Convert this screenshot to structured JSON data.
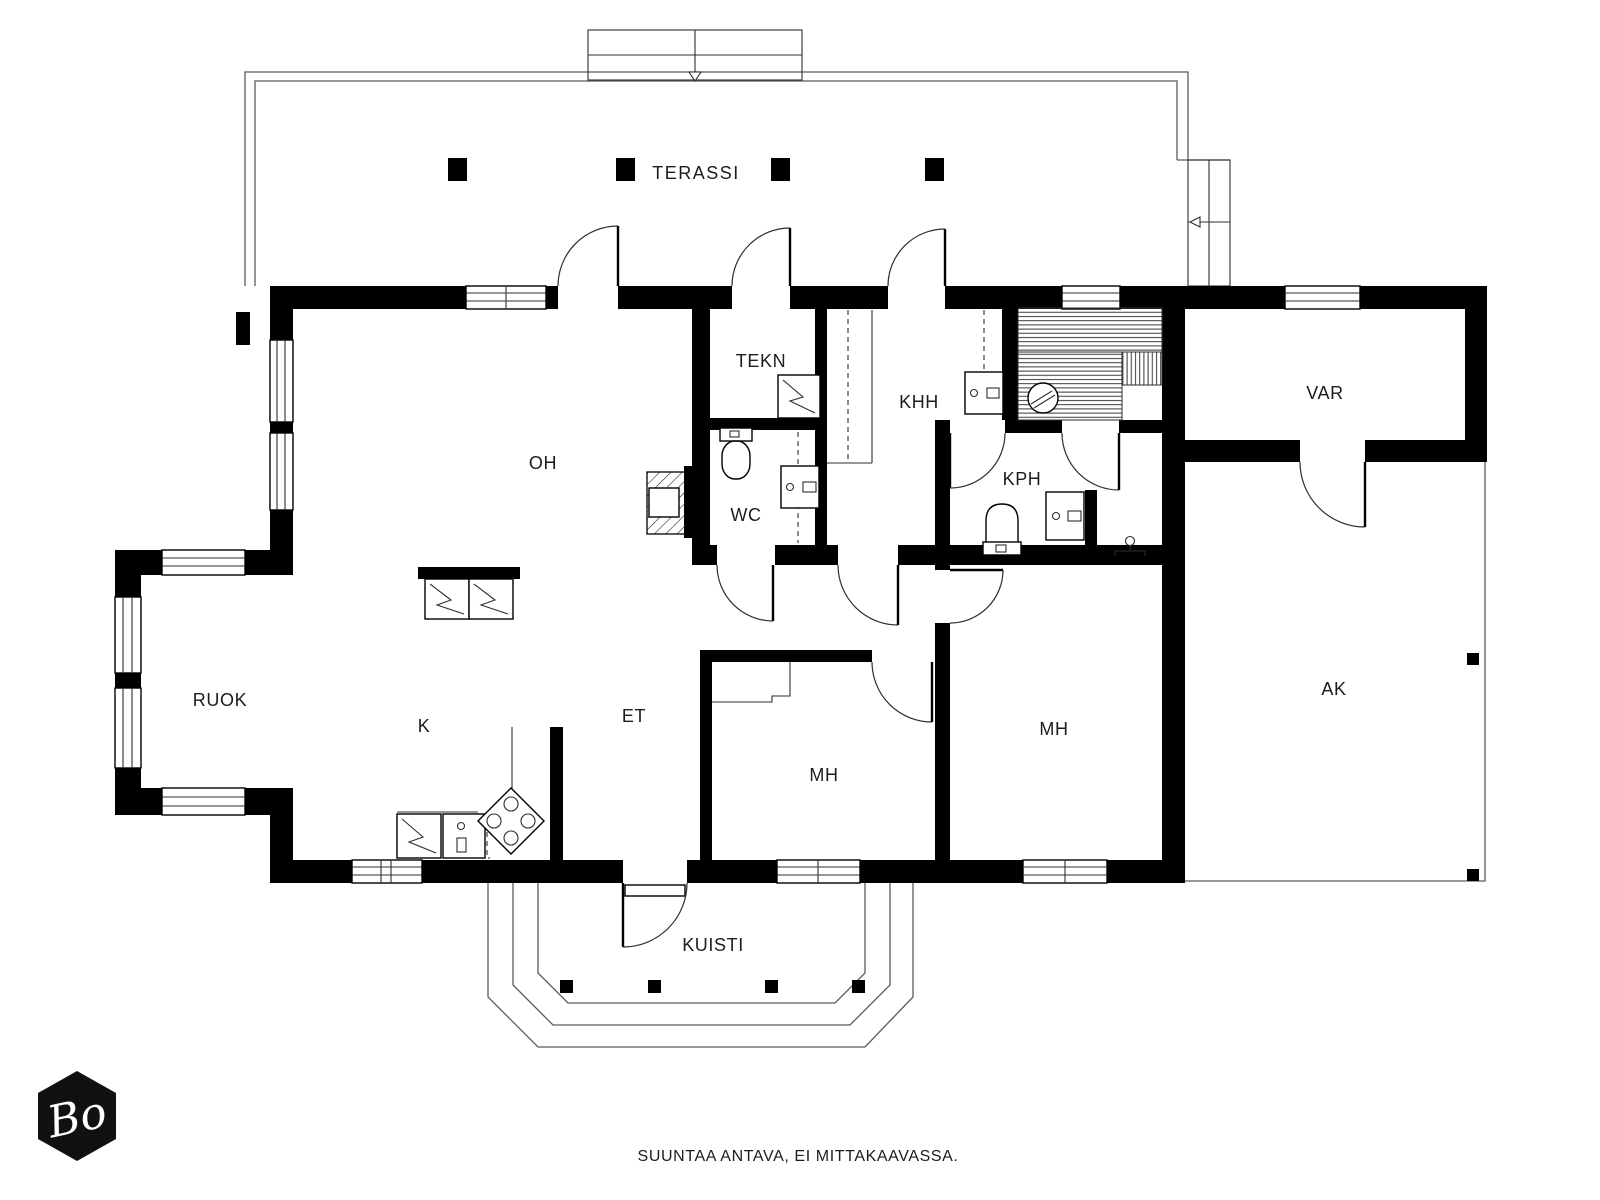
{
  "colors": {
    "wall": "#000000",
    "background": "#ffffff",
    "text": "#1c1c1c",
    "logo_background": "#111111",
    "logo_text": "#ffffff"
  },
  "rooms": {
    "terassi": {
      "label": "TERASSI"
    },
    "oh": {
      "label": "OH"
    },
    "ruok": {
      "label": "RUOK"
    },
    "k": {
      "label": "K"
    },
    "et": {
      "label": "ET"
    },
    "tekn": {
      "label": "TEKN"
    },
    "wc": {
      "label": "WC"
    },
    "khh": {
      "label": "KHH"
    },
    "kph": {
      "label": "KPH"
    },
    "mh_left": {
      "label": "MH"
    },
    "mh_right": {
      "label": "MH"
    },
    "var": {
      "label": "VAR"
    },
    "ak": {
      "label": "AK"
    },
    "kuisti": {
      "label": "KUISTI"
    }
  },
  "footer": {
    "disclaimer": "SUUNTAA ANTAVA, EI MITTAKAAVASSA."
  },
  "logo": {
    "monogram": "Bo"
  }
}
